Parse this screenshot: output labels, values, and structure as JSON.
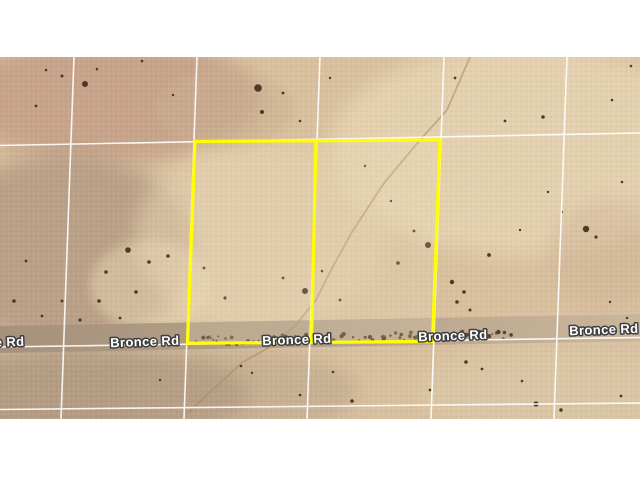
{
  "map": {
    "type": "satellite-imagery-with-parcel-overlay",
    "road_name": "Bronce Rd",
    "road_label_occurrences": 5,
    "parcels_outlined": 2,
    "colors": {
      "background": "#ffffff",
      "terrain_base": "#d8c09f",
      "terrain_pink_patch": "#c09a84",
      "terrain_cream_patch": "#e9d8b6",
      "road_surface": "#b3a18b",
      "gridline": "#ffffff",
      "parcel_outline": "#ffff00",
      "road_label_fill": "#ffffff",
      "road_label_outline": "#3f3f3f",
      "vegetation_dark": "#3e2d1b"
    }
  }
}
